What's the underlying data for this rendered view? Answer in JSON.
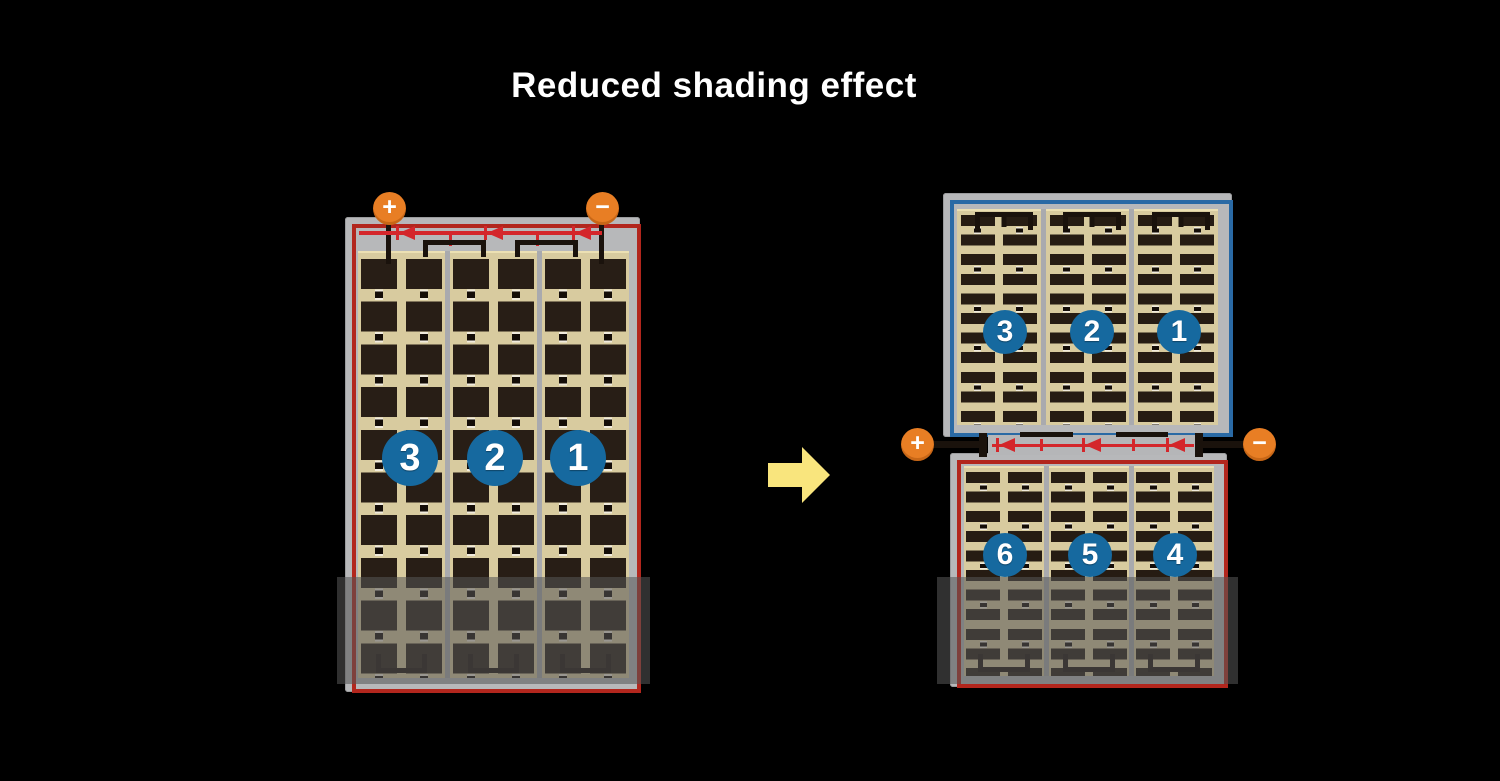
{
  "title": "Reduced shading effect",
  "arrow": {
    "direction": "right"
  },
  "colors": {
    "background": "#000000",
    "title_text": "#ffffff",
    "terminal_orange": "#e87e24",
    "string_number_blue": "#16699f",
    "module_border_red": "#b2261d",
    "module_border_blue": "#2a6aa5",
    "bypass_wire_red": "#d4262b",
    "cell_dark_brown": "#281e16",
    "cell_sheet_tan": "#d8cb9f",
    "frame_gray": "#b7b8ba",
    "arrow_yellow": "#f9e57d",
    "shading_overlay": "rgba(86,86,86,0.56)"
  },
  "left_module": {
    "terminals": {
      "positive": "+",
      "negative": "−"
    },
    "strings": [
      {
        "number": "3"
      },
      {
        "number": "2"
      },
      {
        "number": "1"
      }
    ],
    "bypass_diodes": 3,
    "shaded_bottom": true
  },
  "right_module": {
    "terminals": {
      "positive": "+",
      "negative": "−"
    },
    "top_half": {
      "strings": [
        {
          "number": "3"
        },
        {
          "number": "2"
        },
        {
          "number": "1"
        }
      ]
    },
    "bottom_half": {
      "strings": [
        {
          "number": "6"
        },
        {
          "number": "5"
        },
        {
          "number": "4"
        }
      ]
    },
    "bypass_diodes": 3,
    "shaded_bottom": true
  }
}
